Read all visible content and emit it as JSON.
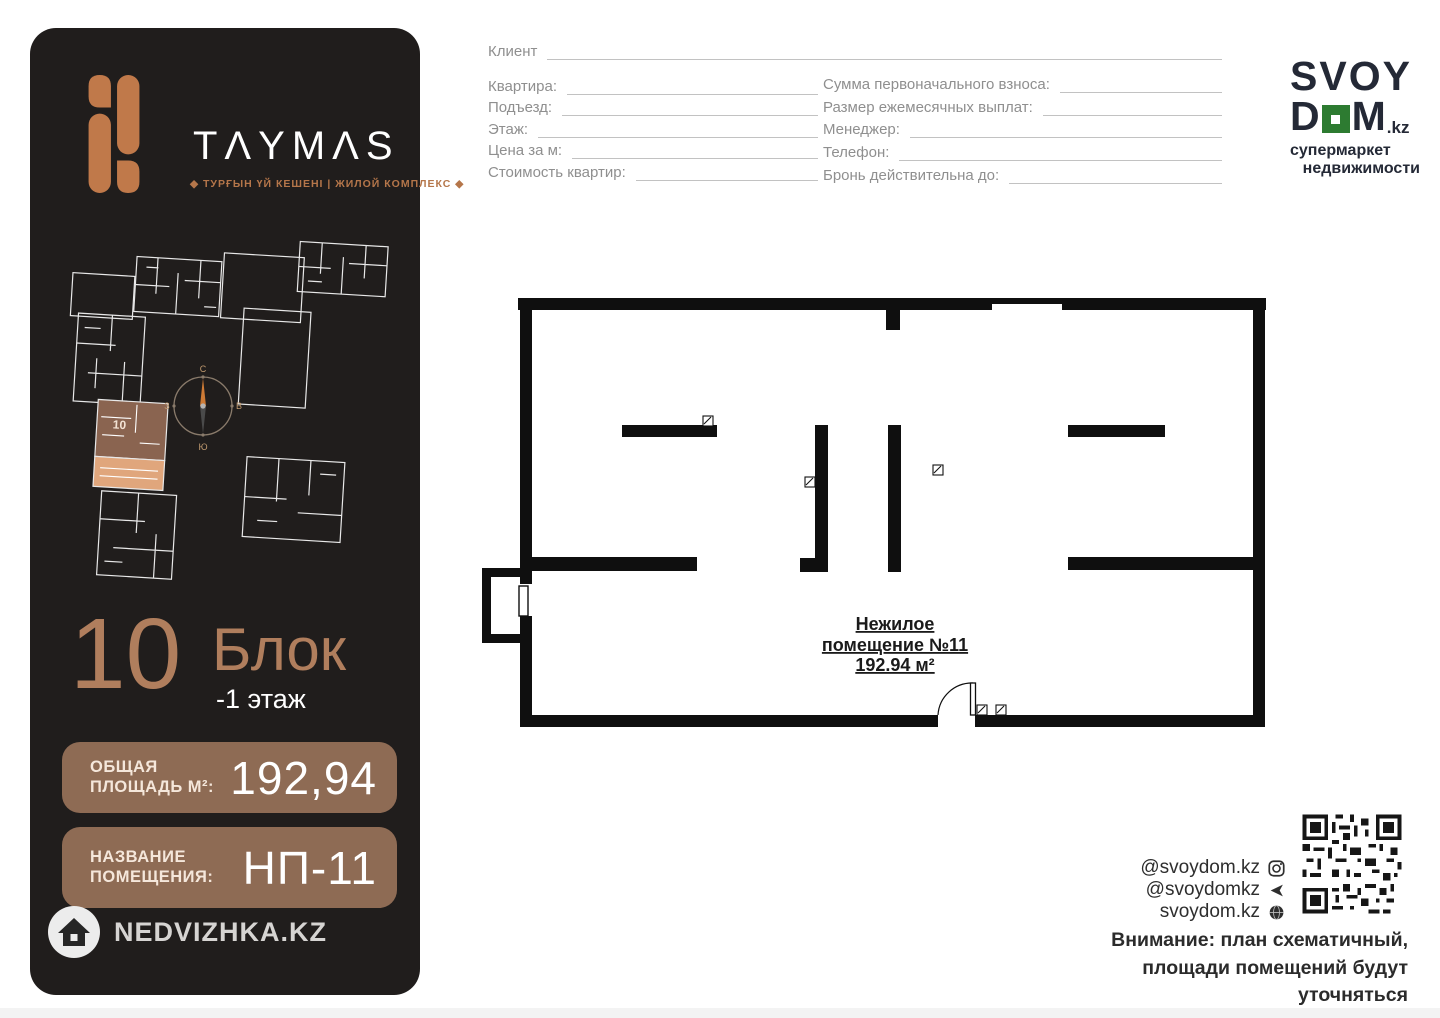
{
  "colors": {
    "panel_bg": "#201d1c",
    "copper_icon": "#c0794a",
    "copper_text": "#b07e5d",
    "badge_bg": "#8e6b54",
    "svoydom_dark": "#242936",
    "svoydom_green": "#2d7b31",
    "wall_black": "#0f0f0f"
  },
  "taymas": {
    "wordmark": "TΛYMΛS",
    "tagline": "◆ ТУРҒЫН ҮЙ КЕШЕНІ | ЖИЛОЙ КОМПЛЕКС ◆"
  },
  "panel": {
    "block_number": "10",
    "block_word": "Блок",
    "floor": "-1 этаж",
    "area_badge": {
      "label1": "ОБЩАЯ",
      "label2": "ПЛОЩАДЬ М²:",
      "value": "192,94"
    },
    "name_badge": {
      "label1": "НАЗВАНИЕ",
      "label2": "ПОМЕЩЕНИЯ:",
      "value": "НП-11"
    },
    "watermark": "NEDVIZHKA.KZ",
    "siteplan_highlight_label": "10",
    "compass": {
      "n": "С",
      "e": "В",
      "s": "Ю",
      "w": "З"
    }
  },
  "form": {
    "client": {
      "label": "Клиент"
    },
    "left_rows": [
      {
        "label": "Квартира:"
      },
      {
        "label": "Подъезд:"
      },
      {
        "label": "Этаж:"
      },
      {
        "label": "Цена за м:"
      },
      {
        "label": "Стоимость квартир:"
      }
    ],
    "right_rows": [
      {
        "label": "Сумма первоначального взноса:"
      },
      {
        "label": "Размер ежемесячных выплат:"
      },
      {
        "label": "Менеджер:"
      },
      {
        "label": "Телефон:"
      },
      {
        "label": "Бронь действительна до:"
      }
    ]
  },
  "svoydom": {
    "top": "SVOY",
    "d": "D",
    "m": "M",
    "tld": ".kz",
    "sub1": "супермаркет",
    "sub2": "недвижимости"
  },
  "plan": {
    "line1": "Нежилое",
    "line2": "помещение №11",
    "line3": "192.94 м²"
  },
  "footer": {
    "handles": [
      {
        "text": "@svoydom.kz",
        "icon": "instagram-icon"
      },
      {
        "text": "@svoydomkz",
        "icon": "telegram-icon"
      },
      {
        "text": "svoydom.kz",
        "icon": "globe-icon"
      }
    ],
    "disclaimer": [
      "Внимание: план схематичный,",
      "площади помещений будут уточняться",
      "после реализации проекта"
    ]
  }
}
